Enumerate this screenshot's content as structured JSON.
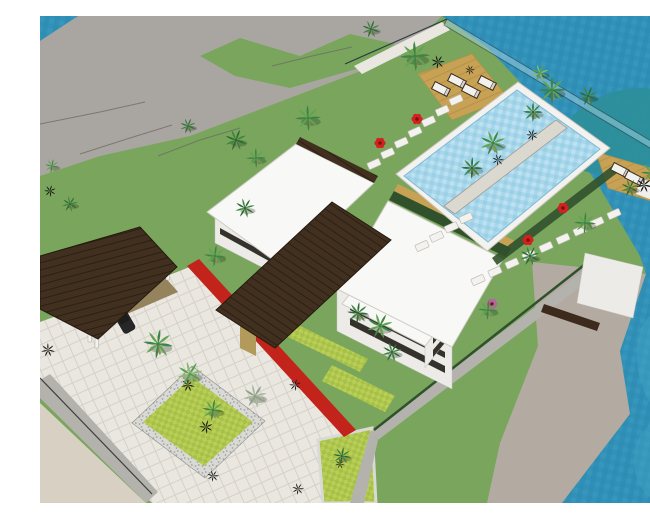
{
  "meta": {
    "kind": "3d-architectural-site-render",
    "width": 650,
    "height": 487
  },
  "colors": {
    "sea_base": "#3191b8",
    "sea_dark": "#2a84ab",
    "sea_light": "#49a5c7",
    "shoal": "#2e8e99",
    "pool_base": "#a8d7eb",
    "pool_dark": "#8cc9e2",
    "lawn": "#79a65c",
    "lawn_shade": "#6e9b52",
    "terrain": "#a9a6a1",
    "beach": "#b3aba2",
    "driveway": "#d8d1c3",
    "paving": "#eae7e0",
    "paving_line": "#d5d1c7",
    "pebble_base": "#d9d9d6",
    "pebble_dot": "#a5a39e",
    "bed_light": "#b8ce55",
    "bed_dark": "#a7c049",
    "hedge": "#31512c",
    "roof_white": "#f8f8f6",
    "roof_edge": "#cfccc4",
    "wall_white": "#ecebe7",
    "window_dark": "#35322c",
    "plank_brown": "#41301f",
    "plank_line": "#2c1f12",
    "deck_tan": "#c7a254",
    "deck_line": "#b6914a",
    "red_wall": "#c2231a",
    "glass": "#a5d2e2",
    "rail_frame": "#2c3c42",
    "stone": "#f3f2ee",
    "stone_edge": "#b9b6ae",
    "path_gray": "#b4b2ad",
    "wall_line": "#3e3e3a",
    "contour": "#6f6c66",
    "trunk": "#9a8a66",
    "plant_black": "#121212",
    "flower_red": "#d32121",
    "flower_core": "#7e1010",
    "flower_magenta": "#b565a3",
    "lounger_white": "#f1f1ee",
    "lounger_brown": "#3a2a1c",
    "car_light": "#9c9c98",
    "car_dark": "#272727",
    "carport_floor": "#bfa878",
    "column_white": "#f2f2f0",
    "island_planter": "#dbd8cf",
    "door_tan": "#b19a5a",
    "mat_white": "#efefec",
    "beam_brown": "#3c2b1d",
    "palm_tones": {
      "dark": [
        "#2d6a33",
        "#3f8340"
      ],
      "mid": [
        "#3e8543",
        "#5fa550"
      ],
      "light": [
        "#58a04e",
        "#86bd68"
      ],
      "gray": [
        "#8da089",
        "#abb9a3"
      ]
    }
  },
  "scene": {
    "palms": [
      [
        375,
        40,
        15,
        "mid"
      ],
      [
        331,
        13,
        9,
        "dark"
      ],
      [
        268,
        102,
        13,
        "mid"
      ],
      [
        196,
        124,
        11,
        "dark"
      ],
      [
        216,
        142,
        10,
        "mid"
      ],
      [
        148,
        110,
        8,
        "dark"
      ],
      [
        512,
        74,
        14,
        "mid"
      ],
      [
        548,
        80,
        10,
        "dark"
      ],
      [
        493,
        96,
        10,
        "dark"
      ],
      [
        453,
        127,
        13,
        "mid"
      ],
      [
        432,
        152,
        11,
        "dark"
      ],
      [
        500,
        57,
        9,
        "light"
      ],
      [
        612,
        157,
        11,
        "mid"
      ],
      [
        590,
        172,
        9,
        "dark"
      ],
      [
        545,
        207,
        11,
        "mid"
      ],
      [
        490,
        240,
        10,
        "dark"
      ],
      [
        448,
        294,
        10,
        "mid"
      ],
      [
        340,
        310,
        13,
        "mid"
      ],
      [
        318,
        297,
        11,
        "dark"
      ],
      [
        352,
        336,
        10,
        "dark"
      ],
      [
        175,
        240,
        11,
        "mid"
      ],
      [
        205,
        192,
        10,
        "dark"
      ],
      [
        118,
        328,
        15,
        "mid"
      ],
      [
        150,
        358,
        13,
        "light"
      ],
      [
        173,
        394,
        11,
        "mid"
      ],
      [
        215,
        380,
        12,
        "gray"
      ],
      [
        302,
        440,
        9,
        "dark"
      ],
      [
        30,
        188,
        8,
        "dark"
      ],
      [
        12,
        150,
        7,
        "mid"
      ]
    ],
    "plants": [
      [
        398,
        46,
        7
      ],
      [
        604,
        169,
        8
      ],
      [
        492,
        119,
        6
      ],
      [
        458,
        144,
        6
      ],
      [
        148,
        369,
        7
      ],
      [
        166,
        411,
        7
      ],
      [
        173,
        460,
        6
      ],
      [
        8,
        334,
        7
      ],
      [
        10,
        175,
        6
      ],
      [
        258,
        473,
        6
      ],
      [
        300,
        448,
        5
      ],
      [
        255,
        369,
        6
      ],
      [
        430,
        54,
        5
      ]
    ],
    "flowers": [
      [
        377,
        103,
        "red"
      ],
      [
        340,
        127,
        "red"
      ],
      [
        523,
        192,
        "red"
      ],
      [
        488,
        224,
        "red"
      ],
      [
        452,
        288,
        "magenta"
      ]
    ],
    "stone_rows": [
      [
        334,
        148,
        416,
        84,
        7
      ],
      [
        438,
        264,
        574,
        198,
        9
      ],
      [
        382,
        230,
        426,
        202,
        4
      ]
    ],
    "loungers": [
      [
        401,
        73
      ],
      [
        417,
        65
      ],
      [
        431,
        75
      ],
      [
        447,
        67
      ],
      [
        580,
        154
      ],
      [
        594,
        162
      ]
    ],
    "cars": [
      [
        62,
        295,
        60,
        "light"
      ],
      [
        84,
        304,
        60,
        "dark"
      ]
    ],
    "contours": [
      [
        0,
        108,
        60,
        96,
        105,
        86
      ],
      [
        40,
        138,
        90,
        122,
        132,
        109
      ],
      [
        232,
        50,
        272,
        40,
        312,
        31
      ],
      [
        118,
        140,
        160,
        124,
        200,
        112
      ]
    ]
  }
}
